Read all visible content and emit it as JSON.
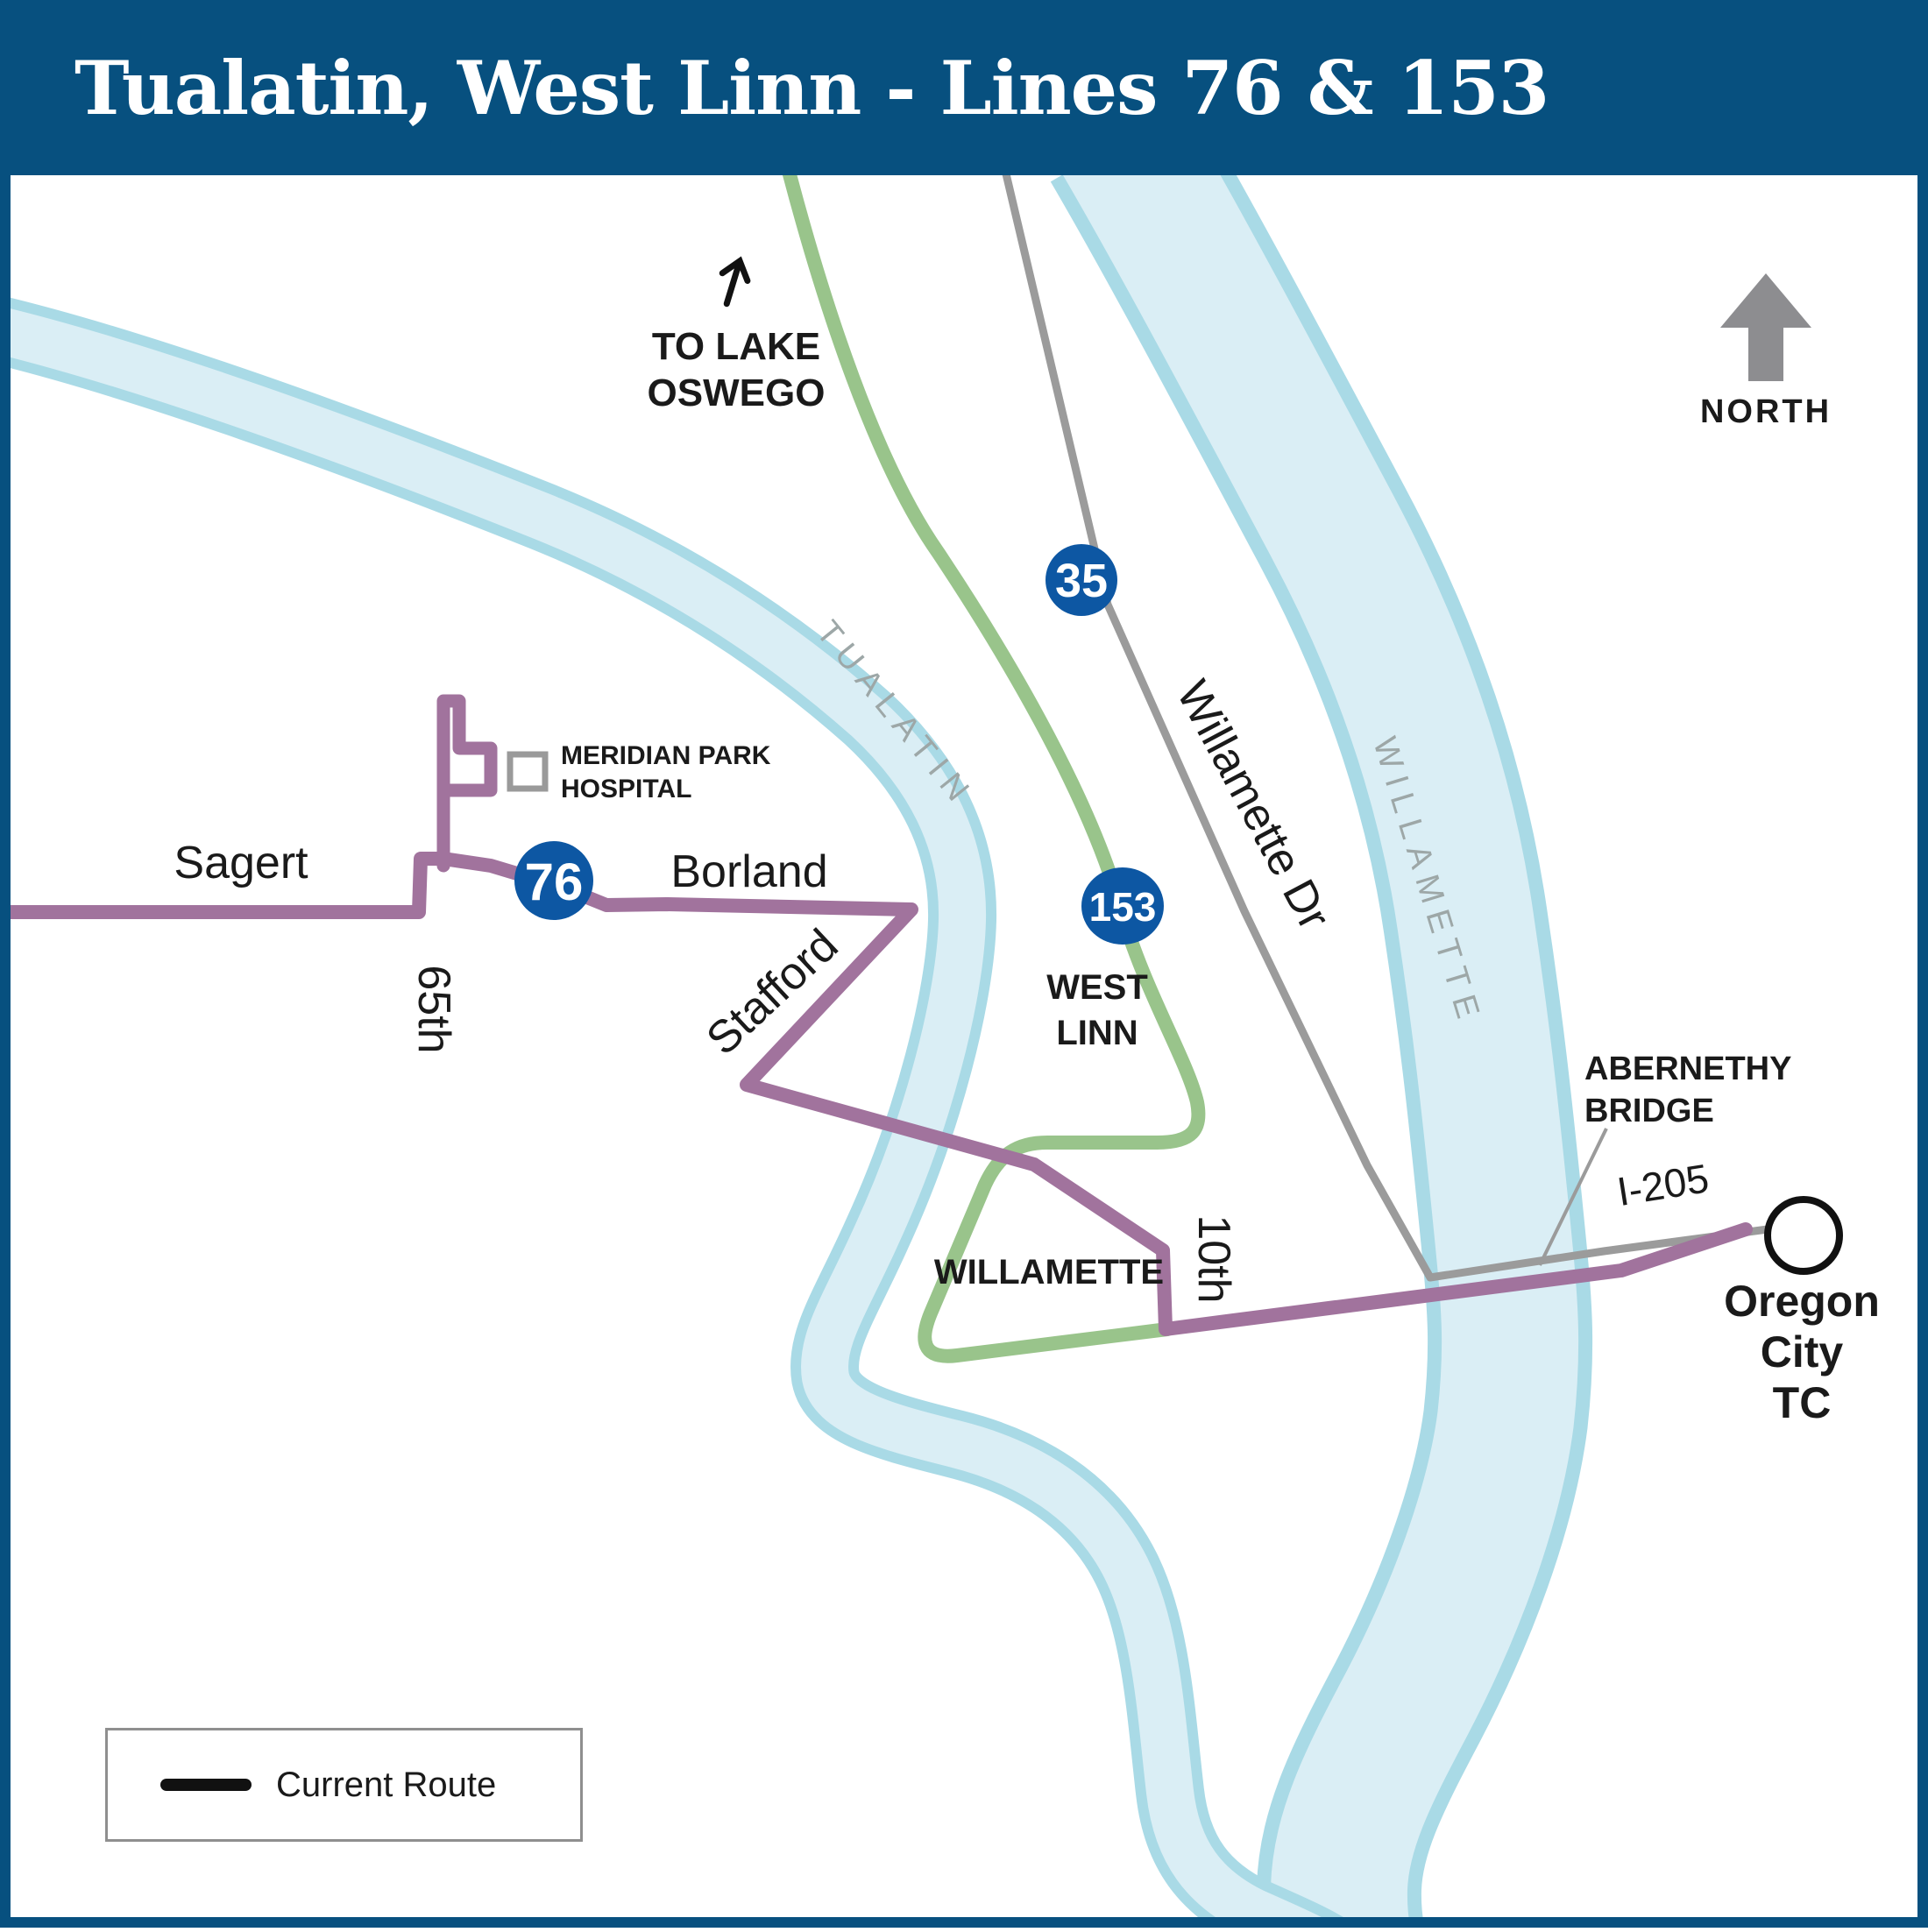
{
  "header": {
    "title": "Tualatin, West Linn - Lines 76 & 153"
  },
  "compass": {
    "label": "NORTH"
  },
  "direction_note": {
    "line1": "TO LAKE",
    "line2": "OSWEGO"
  },
  "route_badges": {
    "line_35": "35",
    "line_76": "76",
    "line_153": "153"
  },
  "streets": {
    "sagert": "Sagert",
    "sixty_fifth": "65th",
    "borland": "Borland",
    "stafford": "Stafford",
    "tenth": "10th",
    "willamette_dr": "Willamette Dr",
    "i205": "I-205"
  },
  "areas": {
    "west_linn_line1": "WEST",
    "west_linn_line2": "LINN",
    "willamette_district": "WILLAMETTE"
  },
  "rivers": {
    "tualatin": "TUALATIN",
    "willamette": "WILLAMETTE"
  },
  "pois": {
    "hospital_line1": "MERIDIAN PARK",
    "hospital_line2": "HOSPITAL",
    "bridge_line1": "ABERNETHY",
    "bridge_line2": "BRIDGE",
    "transit_center_line1": "Oregon",
    "transit_center_line2": "City",
    "transit_center_line3": "TC"
  },
  "legend": {
    "label": "Current Route"
  },
  "colors": {
    "header_navy": "#07507f",
    "badge_blue": "#0d57a3",
    "route_purple": "#a1739d",
    "route_green": "#99c48b",
    "river_fill": "#daeef5",
    "river_edge": "#a9dae6",
    "road_gray": "#9b9b9b"
  }
}
